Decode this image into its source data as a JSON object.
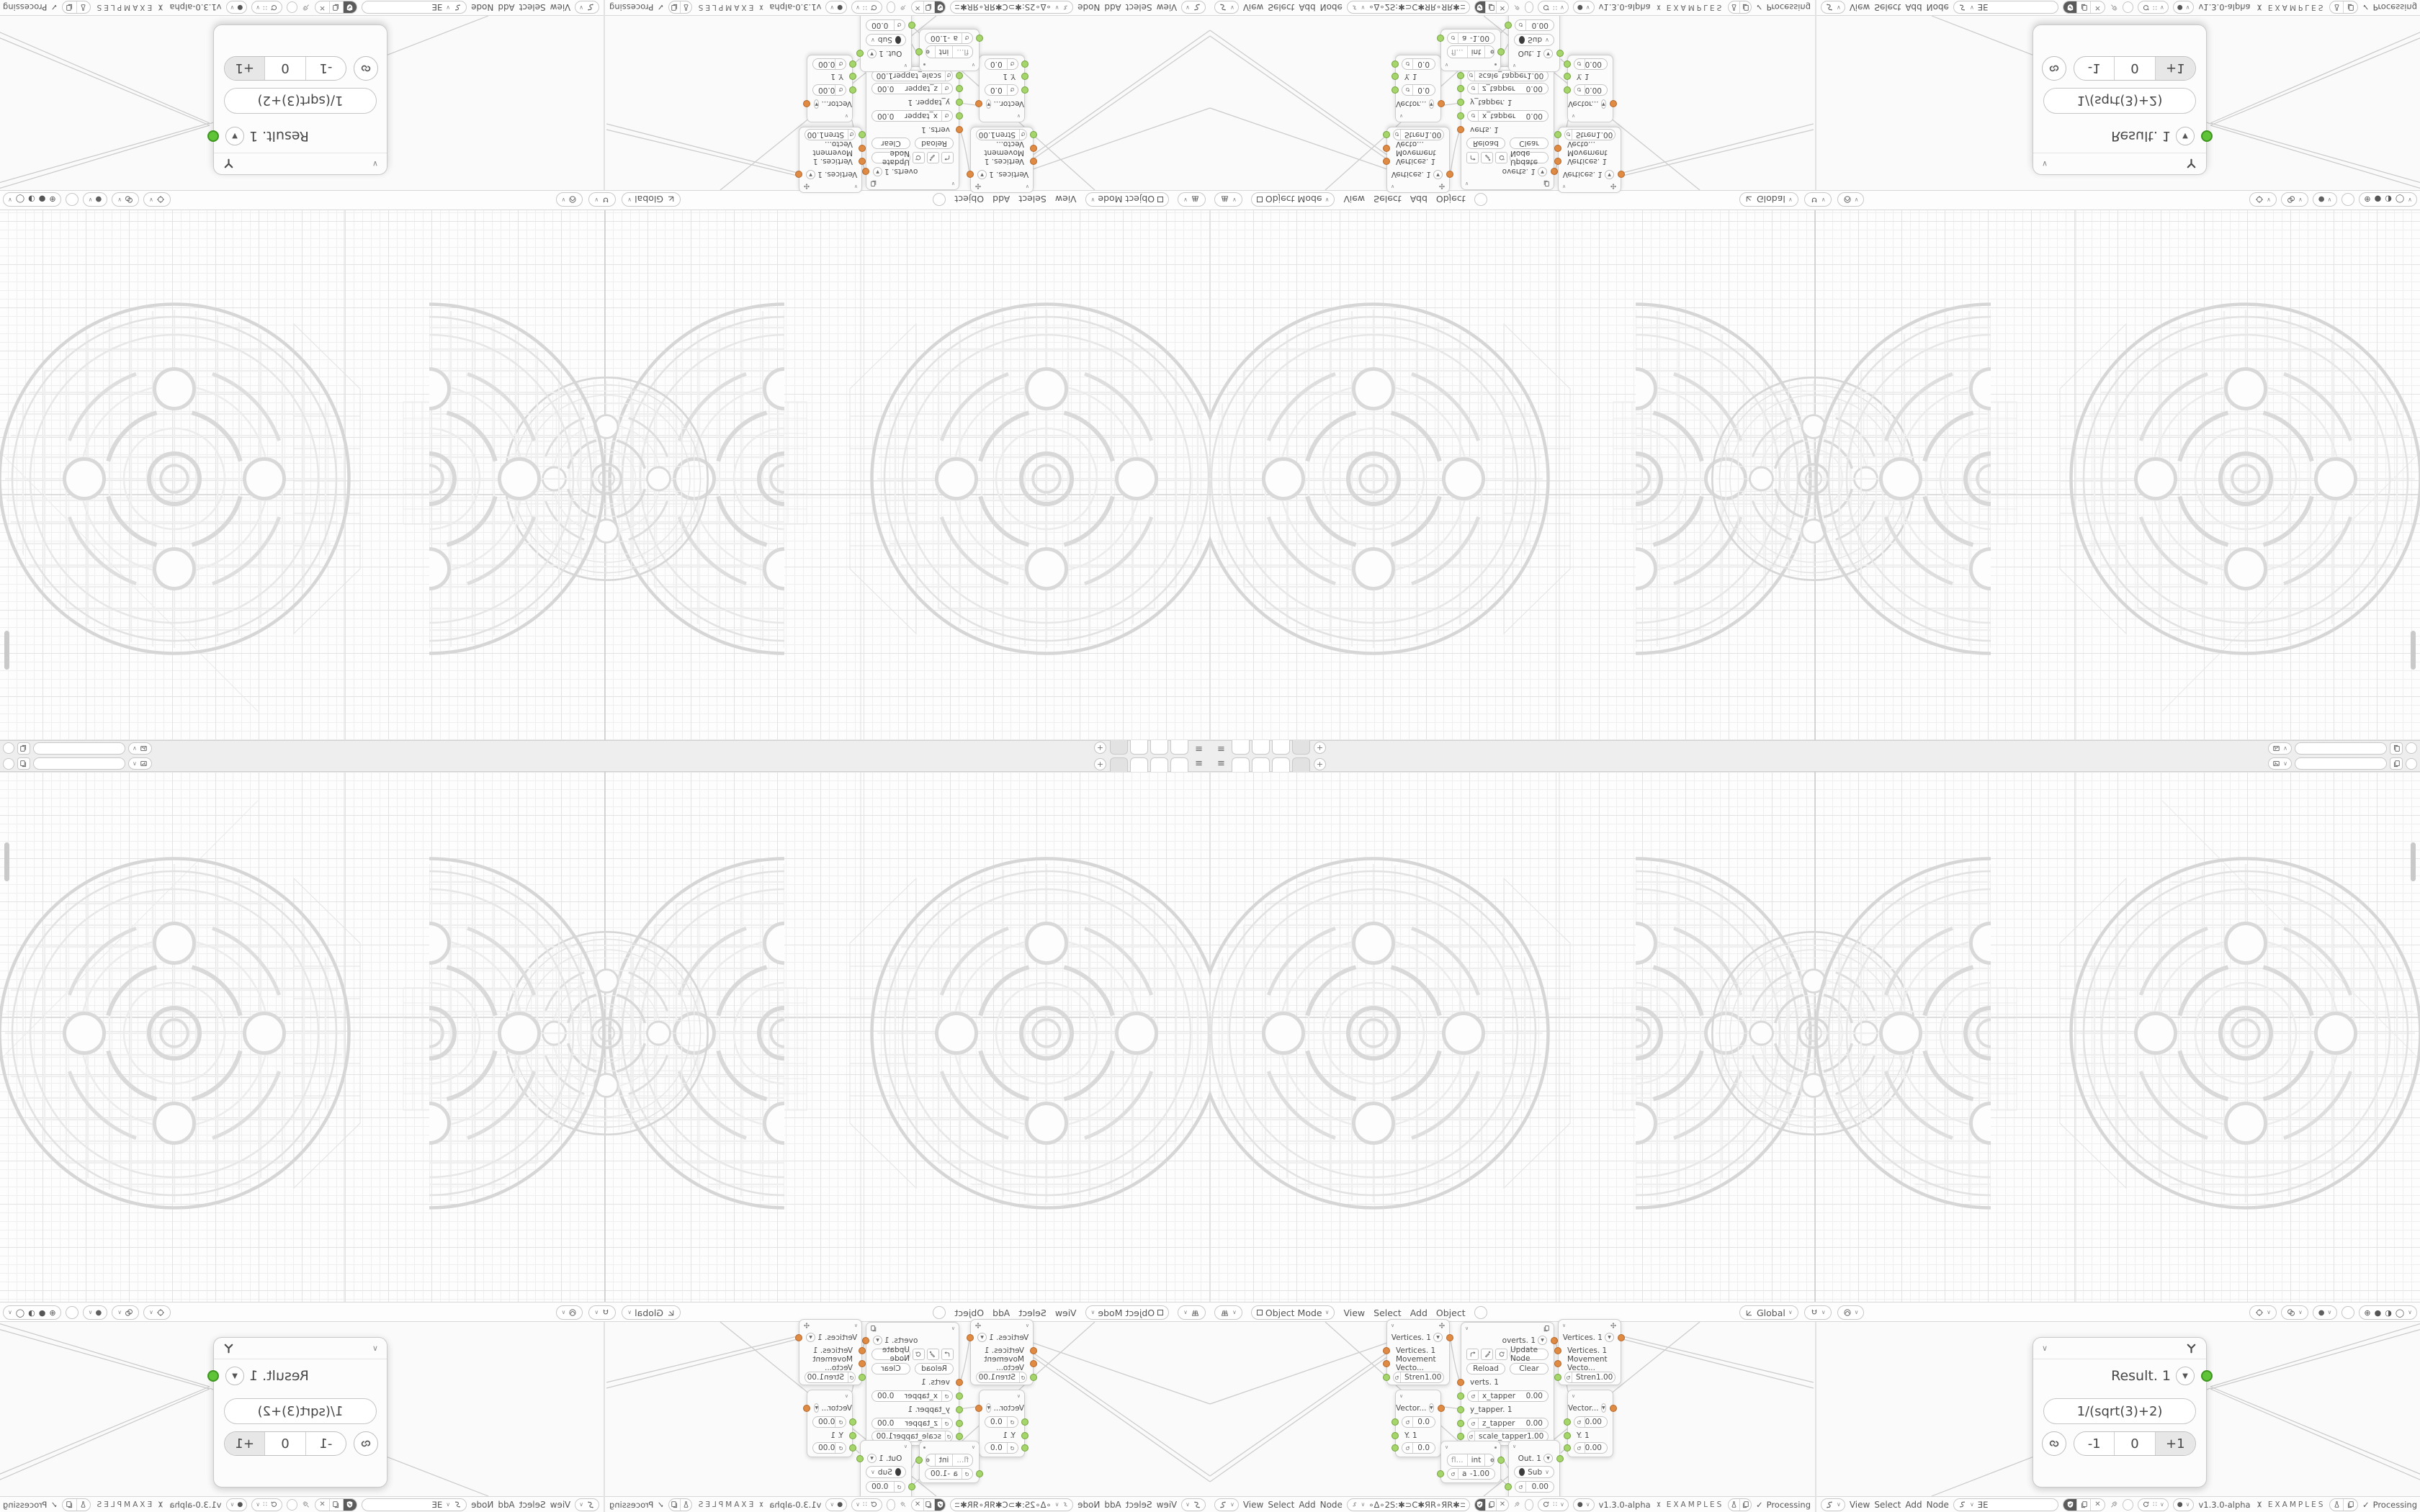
{
  "topbar": {
    "add_tab": "+"
  },
  "viewport_header": {
    "mode": "Object Mode",
    "menus": [
      "View",
      "Select",
      "Add",
      "Object"
    ],
    "orientation": "Global"
  },
  "node_header_a": {
    "menus": [
      "View",
      "Select",
      "Add",
      "Node"
    ],
    "tree_name": "∘Δ∘2S:✱⊃C✱ЯR∘ЯR✱⊃C✱:2S∘Δ∘",
    "version": "v1.3.0-alpha",
    "examples": "EXAMPLES",
    "processing": "Processing"
  },
  "node_header_b": {
    "menus": [
      "View",
      "Select",
      "Add",
      "Node"
    ],
    "tree_name": "ƎE",
    "version": "v1.3.0-alpha",
    "examples": "EXAMPLES",
    "processing": "Processing"
  },
  "nodes": {
    "move_a": {
      "output": "Vertices. 1",
      "in_vertices": "Vertices. 1",
      "in_movement": "Movement Vecto...",
      "strength_label": "Stren",
      "strength_value": "1.00"
    },
    "move_b": {
      "output": "Vertices. 1",
      "in_vertices": "Vertices. 1",
      "in_movement": "Movement Vecto...",
      "strength_label": "Stren",
      "strength_value": "1.00"
    },
    "script": {
      "output": "overts. 1",
      "update": "Update Node",
      "reload": "Reload",
      "clear": "Clear",
      "in_verts": "verts. 1",
      "x_label": "x_tapper",
      "x_value": "0.00",
      "y_link": "y_tapper. 1",
      "z_label": "z_tapper",
      "z_value": "0.00",
      "scale_label": "scale_tapper",
      "scale_value": "1.00"
    },
    "vector_a": {
      "output": "Vector...",
      "v1": "0.0",
      "y_link": "Y. 1",
      "v2": "0.0"
    },
    "vector_b": {
      "output": "Vector...",
      "v1": "0.00",
      "y_link": "Y. 1",
      "v2": "0.00"
    },
    "convert": {
      "opt_float": "fl...",
      "opt_int": "int",
      "a_label": "a",
      "a_value": "-1.00"
    },
    "math": {
      "output": "Out. 1",
      "operation": "Sub",
      "value": "0.00",
      "y_link": "y. 1"
    },
    "result": {
      "title": "Result. 1",
      "expression": "1/(sqrt(3)+2)",
      "decrement": "-1",
      "zero": "0",
      "increment": "+1"
    }
  },
  "colors": {
    "socket_orange": "#e08b44",
    "socket_green": "#a6d56b",
    "socket_output_green": "#5fc437",
    "ui_text": "#4f4f4f"
  }
}
